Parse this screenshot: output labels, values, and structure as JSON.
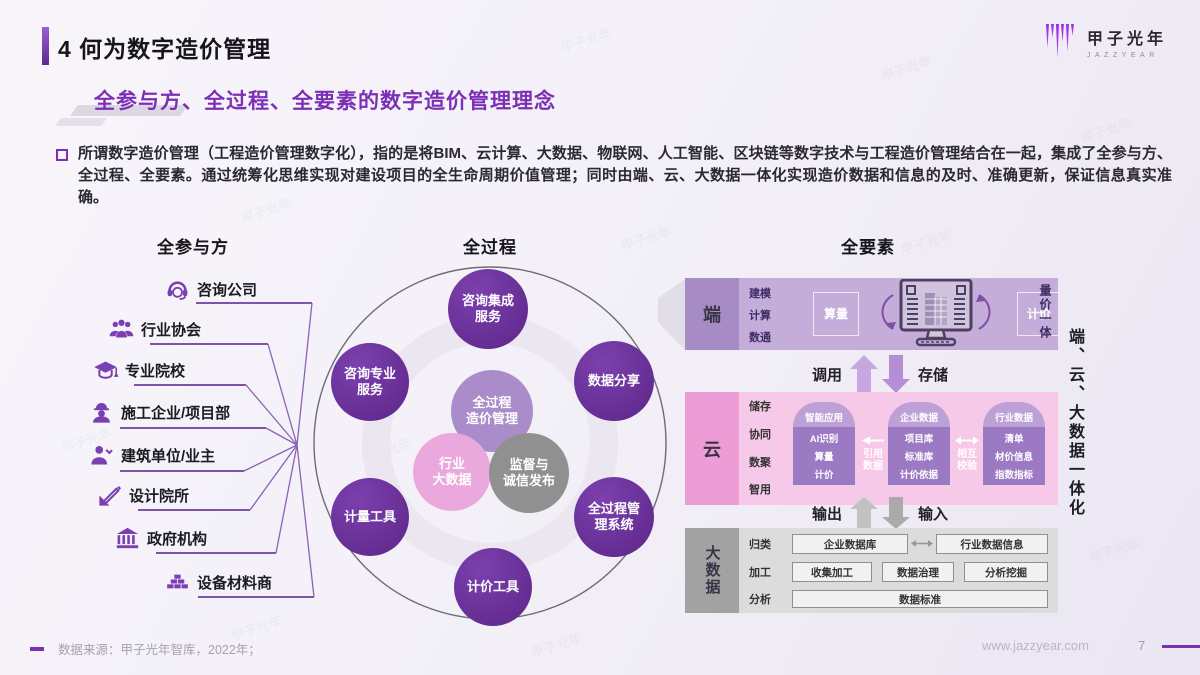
{
  "header": {
    "title": "4 何为数字造价管理",
    "subtitle": "全参与方、全过程、全要素的数字造价管理理念",
    "accent_color": "#7b2fb5"
  },
  "logo": {
    "name": "甲子光年",
    "latin": "JAZZYEAR"
  },
  "intro": {
    "text": "所谓数字造价管理（工程造价管理数字化），指的是将BIM、云计算、大数据、物联网、人工智能、区块链等数字技术与工程造价管理结合在一起，集成了全参与方、全过程、全要素。通过统筹化思维实现对建设项目的全生命周期价值管理；同时由端、云、大数据一体化实现造价数据和信息的及时、准确更新，保证信息真实准确。"
  },
  "participants": {
    "heading": "全参与方",
    "items": [
      {
        "label": "咨询公司",
        "icon": "headset-icon"
      },
      {
        "label": "行业协会",
        "icon": "group-icon"
      },
      {
        "label": "专业院校",
        "icon": "graduation-cap-icon"
      },
      {
        "label": "施工企业/项目部",
        "icon": "worker-icon"
      },
      {
        "label": "建筑单位/业主",
        "icon": "owner-icon"
      },
      {
        "label": "设计院所",
        "icon": "design-icon"
      },
      {
        "label": "政府机构",
        "icon": "government-icon"
      },
      {
        "label": "设备材料商",
        "icon": "materials-icon"
      }
    ]
  },
  "process": {
    "heading": "全过程",
    "circles": [
      {
        "label": "咨询集成\n服务",
        "style": "dark"
      },
      {
        "label": "咨询专业\n服务",
        "style": "dark"
      },
      {
        "label": "数据分享",
        "style": "dark"
      },
      {
        "label": "全过程\n造价管理",
        "style": "light"
      },
      {
        "label": "行业\n大数据",
        "style": "pink"
      },
      {
        "label": "监督与\n诚信发布",
        "style": "gray"
      },
      {
        "label": "计量工具",
        "style": "dark"
      },
      {
        "label": "全过程管\n理系统",
        "style": "dark"
      },
      {
        "label": "计价工具",
        "style": "dark"
      }
    ]
  },
  "elements": {
    "heading": "全要素",
    "side_label": "端、云、大数据一体化",
    "client": {
      "label": "端",
      "features": [
        "建模",
        "计算",
        "数通"
      ],
      "left_box": "算量",
      "right_box": "计价",
      "side_note": "量价一体"
    },
    "flow_top": {
      "up": "调用",
      "down": "存储"
    },
    "cloud": {
      "label": "云",
      "features": [
        "储存",
        "协同",
        "数聚",
        "智用"
      ],
      "arches": [
        {
          "header": "智能应用",
          "items": [
            "AI识别",
            "算量",
            "计价"
          ]
        },
        {
          "header": "企业数据",
          "items": [
            "项目库",
            "标准库",
            "计价依据"
          ]
        },
        {
          "header": "行业数据",
          "items": [
            "清单",
            "材价信息",
            "指数指标"
          ]
        }
      ],
      "link1": "引用\n数据",
      "link2": "相互\n校验"
    },
    "flow_bottom": {
      "up": "输出",
      "down": "输入"
    },
    "bigdata": {
      "label": "大数据",
      "features": [
        "归类",
        "加工",
        "分析"
      ],
      "row1": [
        "企业数据库",
        "行业数据信息"
      ],
      "row2": [
        "收集加工",
        "数据治理",
        "分析挖掘"
      ],
      "row3": "数据标准"
    }
  },
  "footer": {
    "source": "数据来源：甲子光年智库，2022年；",
    "url": "www.jazzyear.com",
    "page": "7"
  },
  "colors": {
    "dark_purple": "#662d91",
    "light_purple": "#a98cc9",
    "pink": "#eba8dc",
    "gray": "#909090",
    "cloud_pink": "#f6c9e8",
    "client_purple": "#c4add9"
  }
}
